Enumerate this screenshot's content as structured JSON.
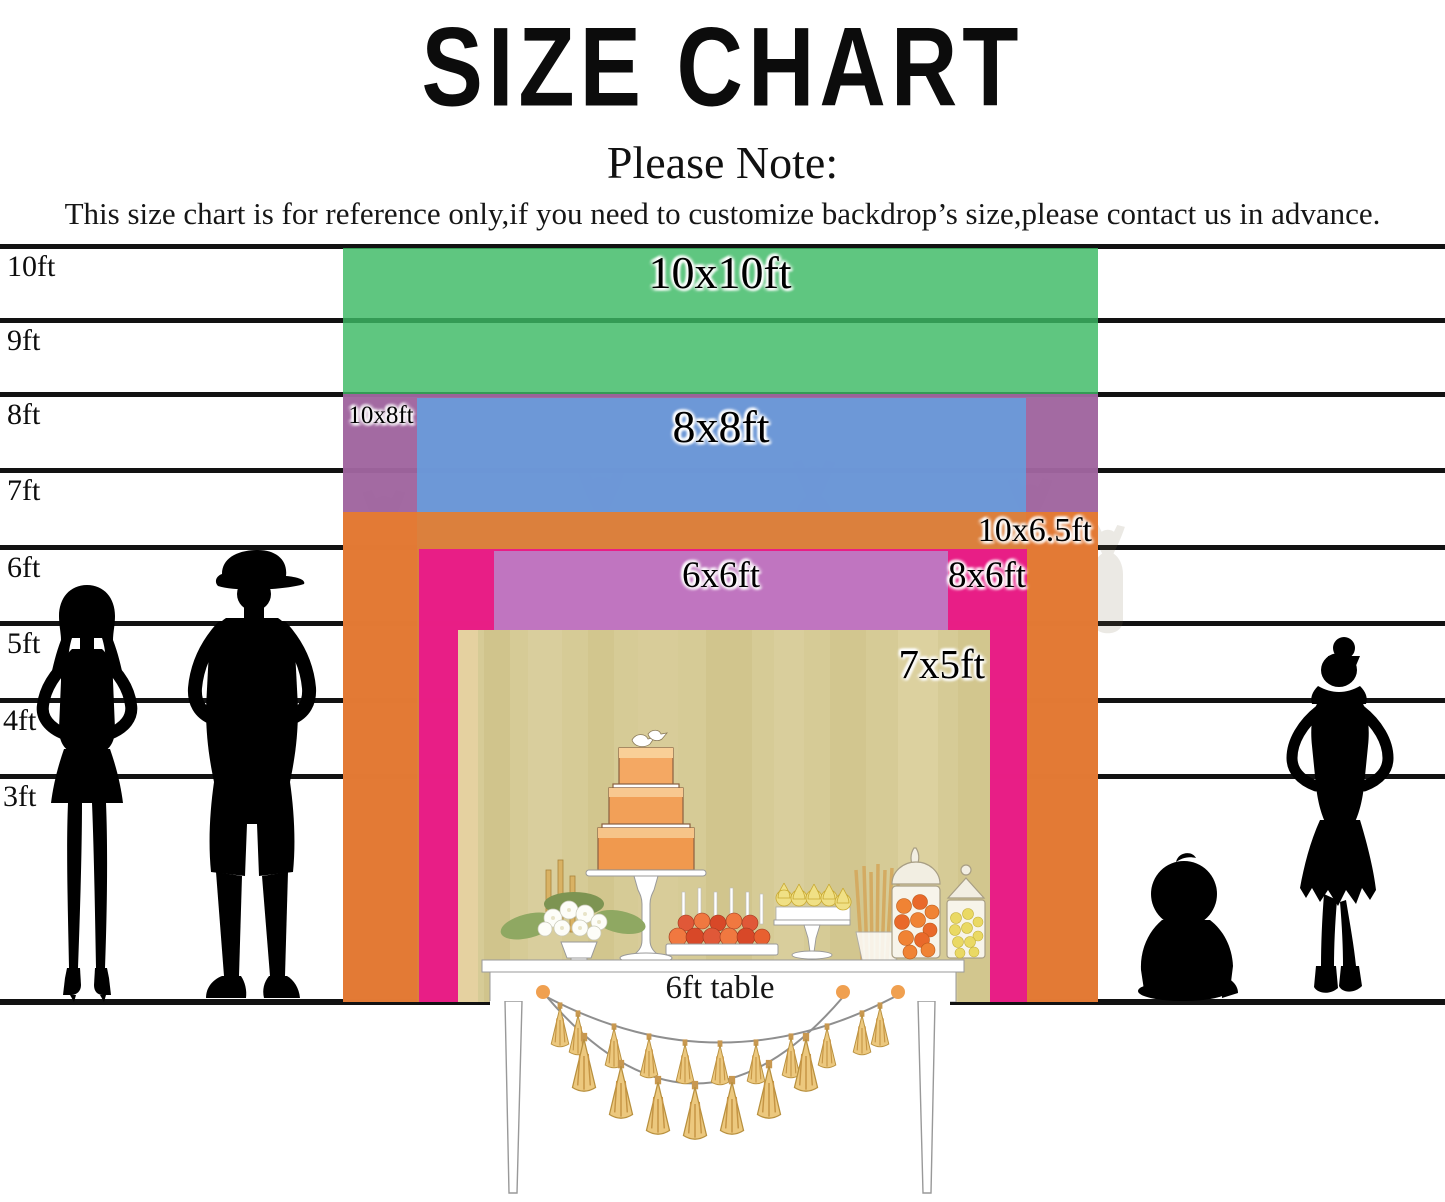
{
  "title": "SIZE CHART",
  "note": {
    "heading": "Please Note:",
    "body": "This size chart is for reference only,if you need to customize backdrop’s size,please contact us in advance."
  },
  "ruler_labels": [
    "10ft",
    "9ft",
    "8ft",
    "7ft",
    "6ft",
    "5ft",
    "4ft",
    "3ft"
  ],
  "backdrops": [
    {
      "label": "10x10ft",
      "width_ft": 10,
      "height_ft": 10,
      "color": "#5fc680"
    },
    {
      "label": "10x8ft",
      "width_ft": 10,
      "height_ft": 8,
      "color": "#c075b8"
    },
    {
      "label": "8x8ft",
      "width_ft": 8,
      "height_ft": 8,
      "color": "#7baee6"
    },
    {
      "label": "10x6.5ft",
      "width_ft": 10,
      "height_ft": 6.5,
      "color": "#f1954d"
    },
    {
      "label": "8x6ft",
      "width_ft": 8,
      "height_ft": 6,
      "color": "#ec2e9f"
    },
    {
      "label": "6x6ft",
      "width_ft": 6,
      "height_ft": 6,
      "color": "#c191cf"
    },
    {
      "label": "7x5ft",
      "width_ft": 7,
      "height_ft": 5,
      "color": "#d6cb96"
    }
  ],
  "table_label": "6ft table"
}
